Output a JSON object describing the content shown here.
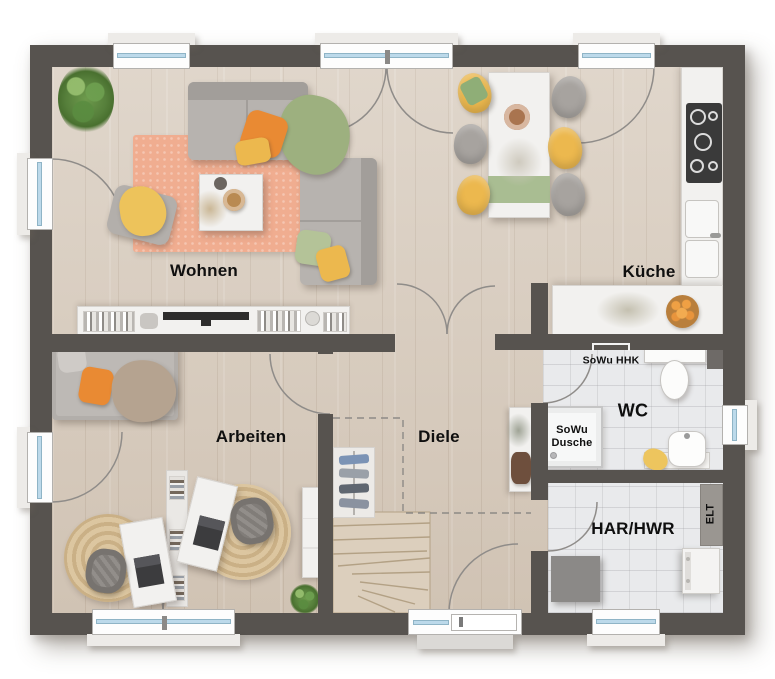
{
  "rooms": {
    "wohnen": "Wohnen",
    "kueche": "Küche",
    "arbeiten": "Arbeiten",
    "diele": "Diele",
    "wc": "WC",
    "har_hwr": "HAR/HWR"
  },
  "features": {
    "sowu_hhk": "SoWu HHK",
    "sowu_dusche": [
      "SoWu",
      "Dusche"
    ],
    "elt": "ELT"
  },
  "colors": {
    "wall": "#57534f",
    "wood": "#d8ccbe",
    "tile": "#e9eaec",
    "counter": "#f2f1ef",
    "glass": "#bcd9ea",
    "orange": "#e98a33",
    "yellow": "#ecb84e",
    "green": "#9db07f",
    "sage": "#a9bd92",
    "rug": "#f0ad90",
    "jute": "#d8c19b",
    "sofa": "#b7b3af",
    "label": "#0f0f0f"
  }
}
